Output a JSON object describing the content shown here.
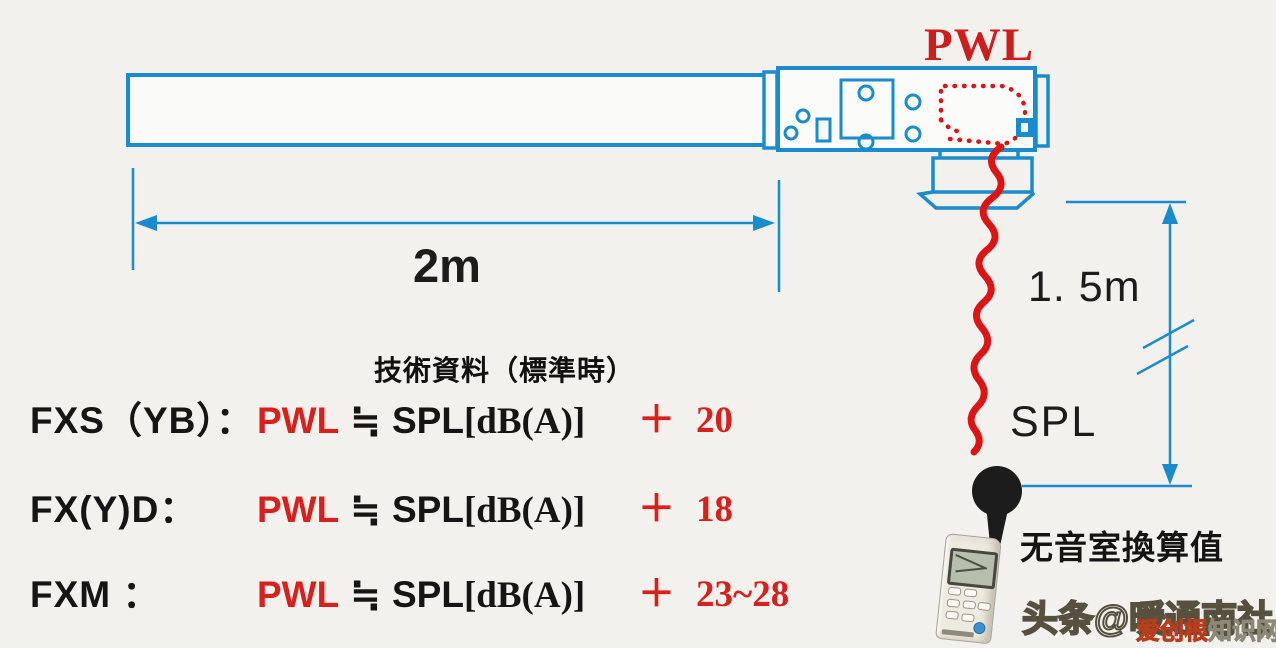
{
  "diagram": {
    "pwl_label": "PWL",
    "spl_label": "SPL",
    "duct_length_label": "2m",
    "mic_distance_label": "1. 5m",
    "anechoic_note": "无音室換算值"
  },
  "formulas": {
    "heading": "技術資料（標準時）",
    "rows": [
      {
        "model": "FXS（YB）：",
        "lhs": "PWL",
        "relation": "≒",
        "rhs_spl": "SPL",
        "rhs_unit": "[dB(A)]",
        "plus": "＋",
        "value": "20"
      },
      {
        "model": "FX(Y)D：",
        "lhs": "PWL",
        "relation": "≒",
        "rhs_spl": "SPL",
        "rhs_unit": "[dB(A)]",
        "plus": "＋",
        "value": "18"
      },
      {
        "model": "FXM ：",
        "lhs": "PWL",
        "relation": "≒",
        "rhs_spl": "SPL",
        "rhs_unit": "[dB(A)]",
        "plus": "＋",
        "value": "23~28"
      }
    ]
  },
  "watermark": {
    "main": "头条@暖通南社",
    "overlay_left": "爱创根",
    "overlay_right": "知识网"
  },
  "colors": {
    "line_blue": "#1a8ccd",
    "accent_red": "#d8211c",
    "wave_red": "#dd1414",
    "text_black": "#1a1a1a",
    "background": "#f2f1ee",
    "watermark_gray": "#57503f",
    "overlay_red": "#e2512a"
  }
}
